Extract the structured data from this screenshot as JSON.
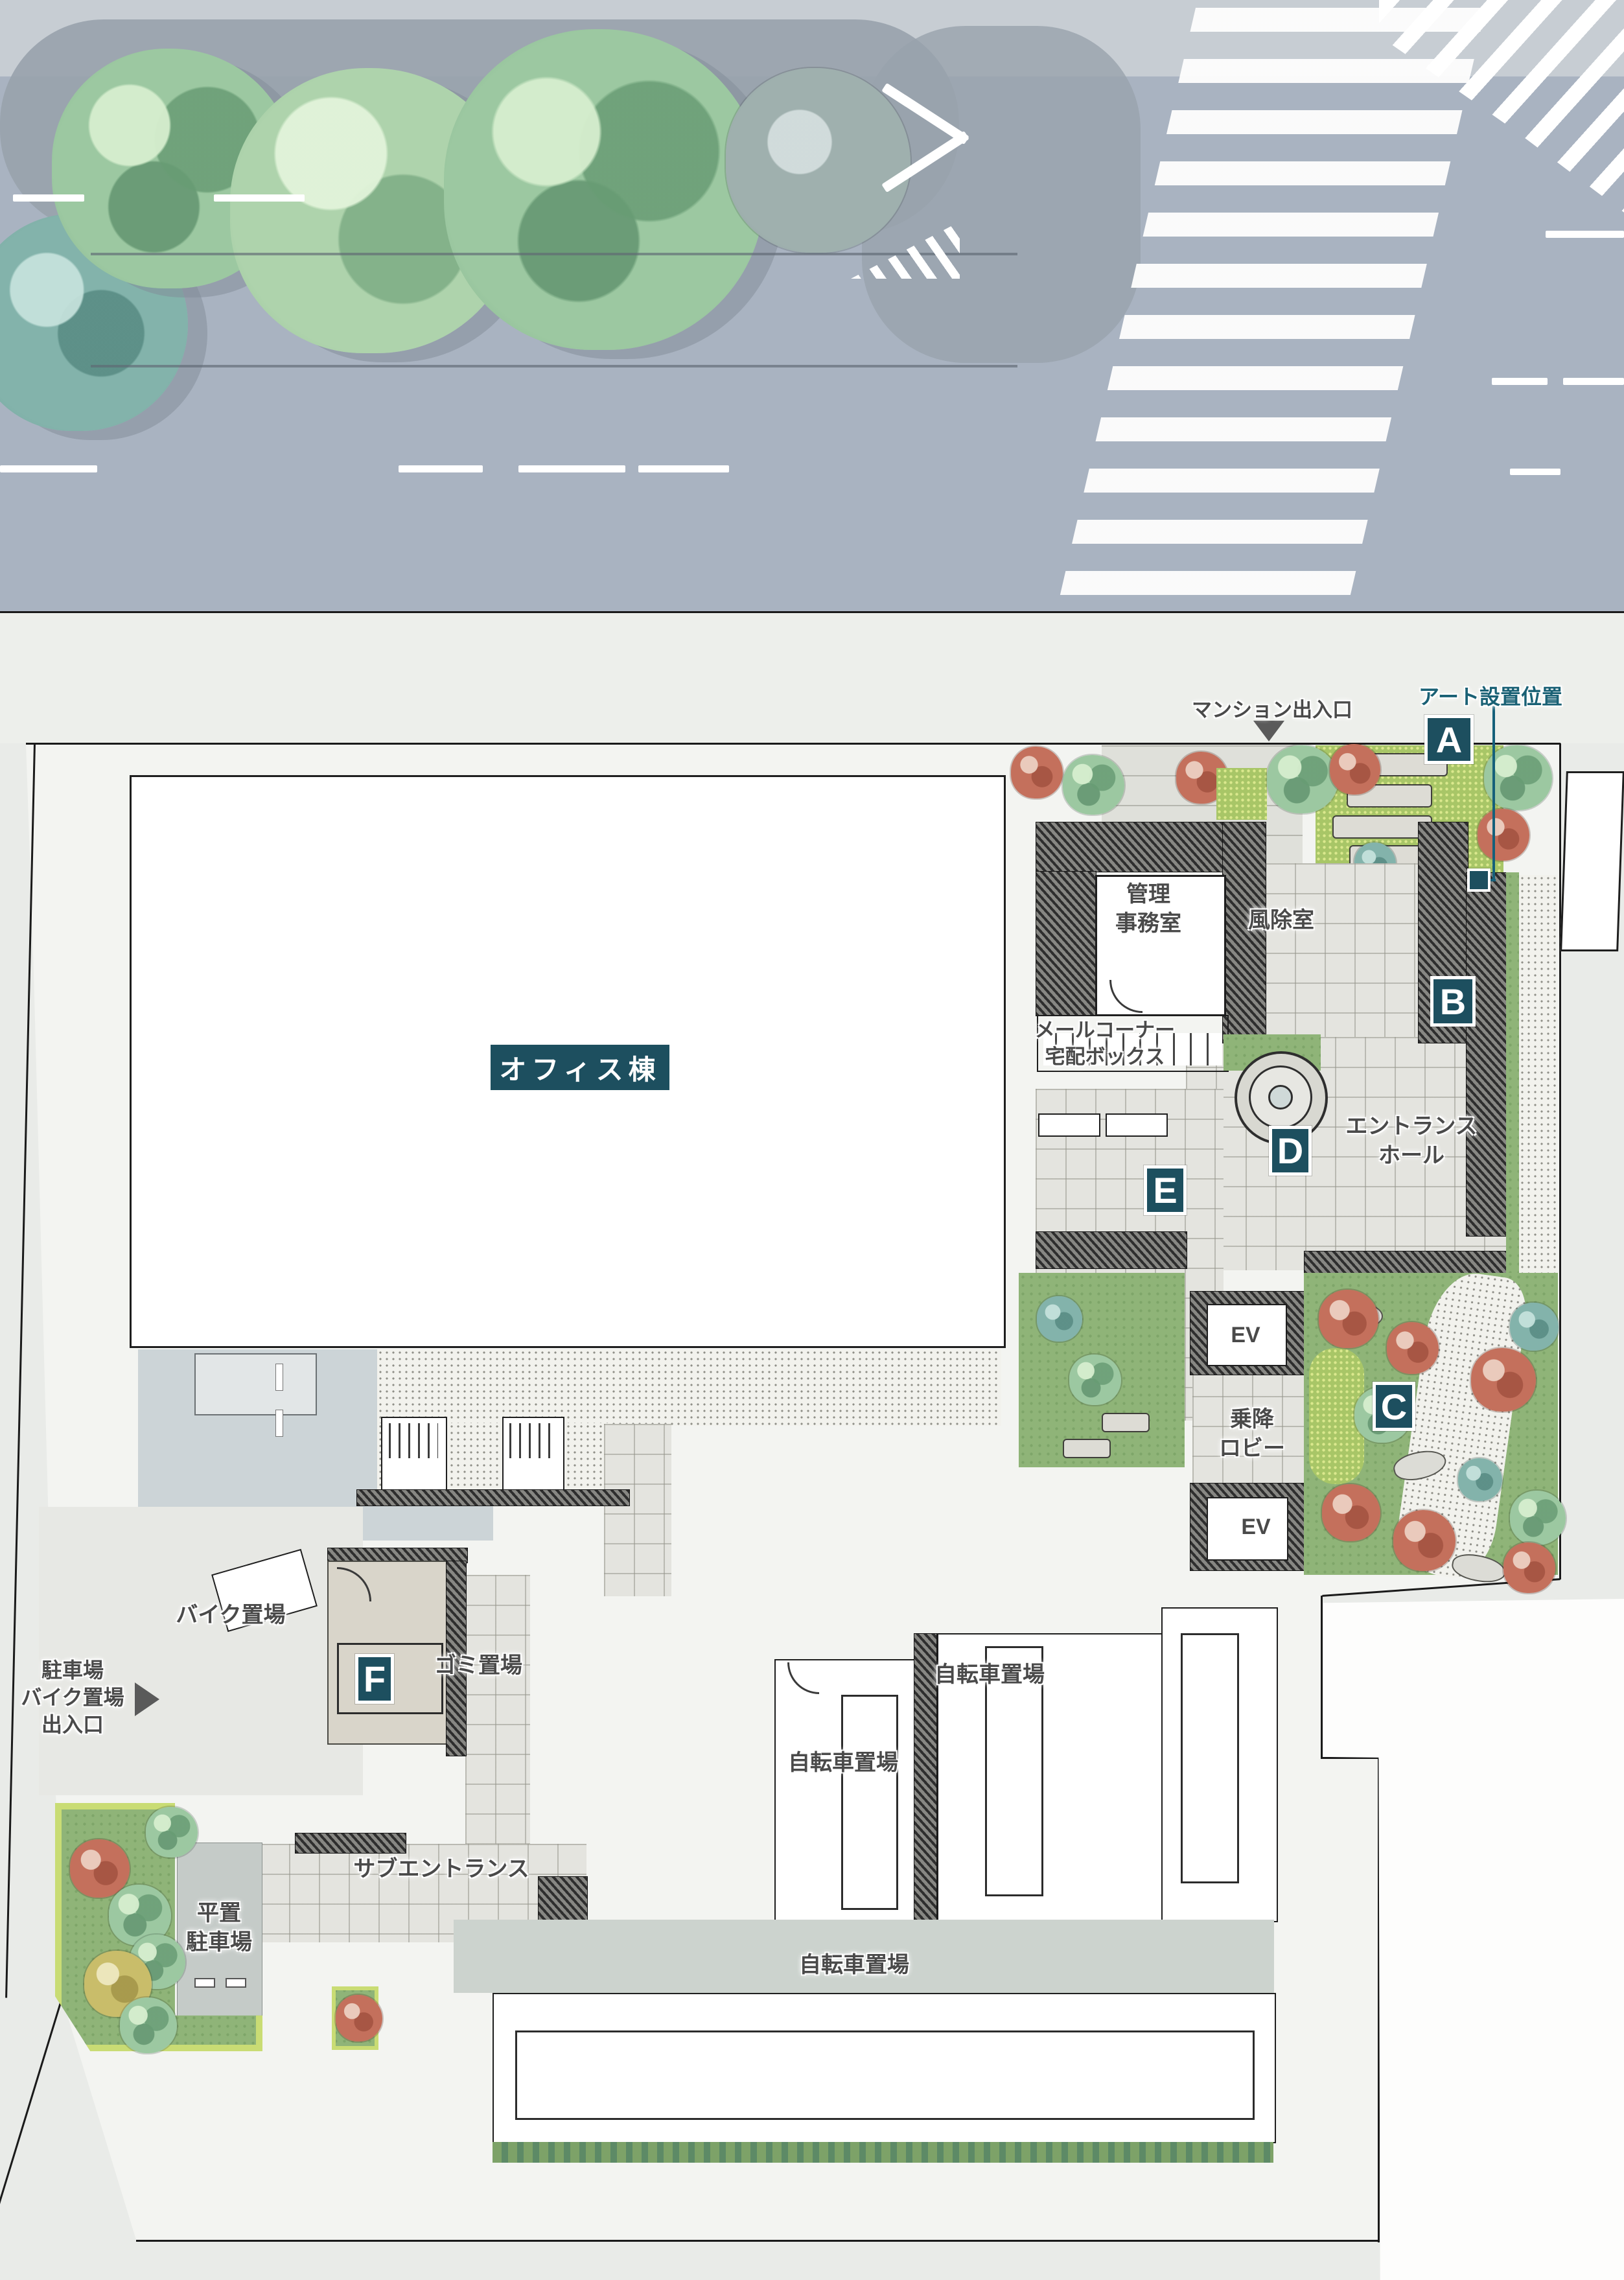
{
  "colors": {
    "accent_teal": "#1d4f5f",
    "teal_text": "#1a6175",
    "road_grey": "#a9b3c1",
    "lawn_green": "#8fb478",
    "site_bg": "#f3f4f1"
  },
  "annotations": {
    "art_position": "アート設置位置",
    "mansion_exit": "マンション出入口",
    "parking_exit_l1": "駐車場",
    "parking_exit_l2": "バイク置場",
    "parking_exit_l3": "出入口"
  },
  "markers": [
    {
      "label": "A"
    },
    {
      "label": "B"
    },
    {
      "label": "C"
    },
    {
      "label": "D"
    },
    {
      "label": "E"
    },
    {
      "label": "F"
    }
  ],
  "rooms": {
    "office": "オフィス棟",
    "kanri_l1": "管理",
    "kanri_l2": "事務室",
    "windbreak": "風除室",
    "mail_l1": "メールコーナー",
    "mail_l2": "宅配ボックス",
    "hall_l1": "エントランス",
    "hall_l2": "ホール",
    "elevator": "EV",
    "lobby_l1": "乗降",
    "lobby_l2": "ロビー",
    "bike": "バイク置場",
    "garbage": "ゴミ置場",
    "bicycle": "自転車置場",
    "sub_entrance": "サブエントランス",
    "flat_l1": "平置",
    "flat_l2": "駐車場"
  }
}
